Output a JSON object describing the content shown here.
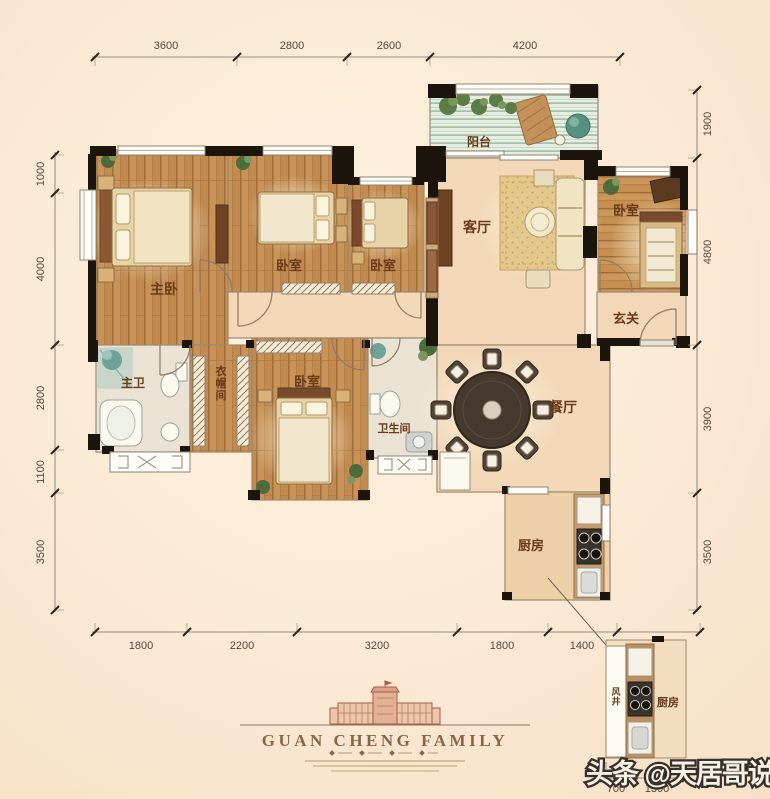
{
  "watermark": {
    "text": "头条 @天居哥说房"
  },
  "footer": {
    "brand": "GUAN CHENG FAMILY"
  },
  "rooms": {
    "master_bedroom": "主卧",
    "bedroom2": "卧室",
    "bedroom3": "卧室",
    "bedroom4": "卧室",
    "bedroom_right": "卧室",
    "living": "客厅",
    "dining": "餐厅",
    "kitchen": "厨房",
    "balcony": "阳台",
    "master_bath": "主卫",
    "bathroom": "卫生间",
    "closet": "衣帽间",
    "foyer": "玄关"
  },
  "inset": {
    "air_shaft": "风井",
    "kitchen": "厨房",
    "dims": [
      "700",
      "1300"
    ]
  },
  "dimensions": {
    "top": [
      "3600",
      "2800",
      "2600",
      "4200"
    ],
    "left": [
      "1000",
      "4000",
      "2800",
      "1100",
      "3500"
    ],
    "right": [
      "1900",
      "4800",
      "3900",
      "3500"
    ],
    "bottom": [
      "1800",
      "2200",
      "3200",
      "1800",
      "1400",
      "2800"
    ]
  },
  "colors": {
    "background": "#fbe9d4",
    "wood_floor": "#c08a50",
    "beige_floor": "#f2d8b8",
    "wall_black": "#1b150e",
    "label_brown": "#6a3a18",
    "balcony_deck": "#e4ecdf"
  }
}
